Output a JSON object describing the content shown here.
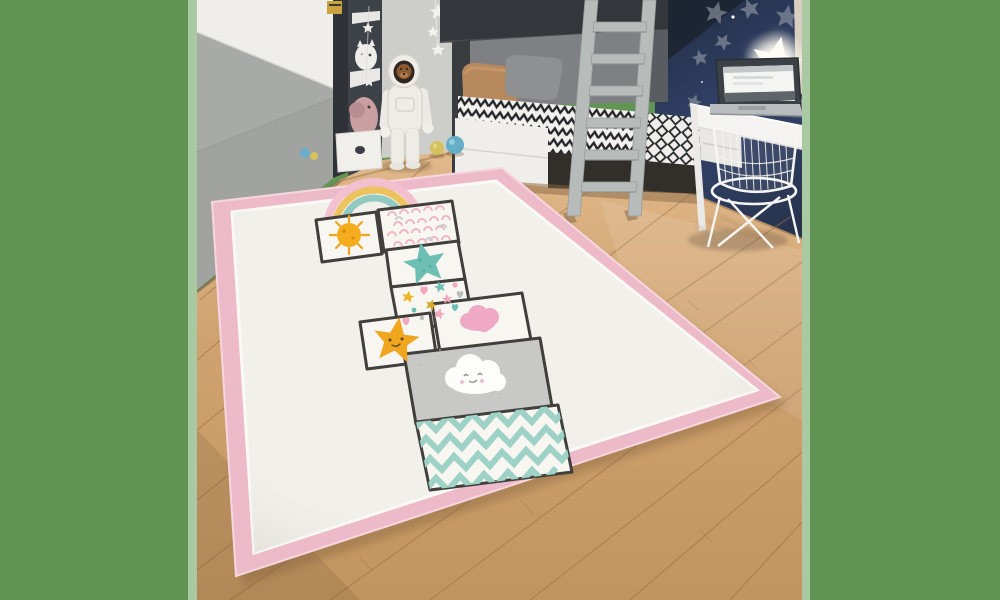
{
  "image_kind": "photograph",
  "description": "Children's bedroom with a large cream hopscotch play rug with pink border on a light oak floor; grey wardrobe and shelf unit on the left, astronaut figure, bunk bed with grey ladder, navy star wall with glowing star lamp, white desk with laptop and white wire chair on the right; solid green matte bands on both sides of the photo.",
  "matte": {
    "band_color": "#619353",
    "edge_strip_color": "#a9c9a3",
    "left_band_width_px": 197,
    "right_band_start_px": 802
  },
  "room": {
    "floor": "light oak laminate planks laid diagonally",
    "wardrobe": "grey sliding wardrobe with white angled wedge panel",
    "shelf_unit": "dark charcoal shelf column with white shelves, white cat ornament, pink elephant plush, white drawer box",
    "back_wall": "light grey wall with hanging white star garland",
    "astronaut_figure": "white astronaut suit figure with teddy-bear face in visor",
    "bunk_bed": "dark-frame bunk bed, black and white zigzag bedding, tan and grey pillows",
    "ladder": "light grey bunk ladder with six rungs",
    "navy_wall": "dark navy-blue wall scattered with soft grey stars",
    "star_lamp": "bright glowing white star night-light",
    "glow_text": "hel",
    "desk": "white desk with open laptop showing a white window",
    "chair": "white wire-frame chair",
    "balls": [
      "blue ball",
      "yellow-green ball",
      "small blue ball",
      "small yellow ball"
    ]
  },
  "rug": {
    "type": "hopscotch kids rug",
    "border_color": "#edbac9",
    "border_inner_line": "#fbf9f5",
    "field_color": "#f2f0ea",
    "outline_color": "#413f3c",
    "rainbow_colors": [
      "#f3c0d0",
      "#edc35e",
      "#92cac1"
    ],
    "tiles": [
      {
        "pos": 1,
        "motif": "scribbled sun",
        "color": "#f5ad1e"
      },
      {
        "pos": 2,
        "motif": "pink scallop pattern",
        "color": "#efb6c6"
      },
      {
        "pos": 3,
        "motif": "teal star",
        "color": "#6cbfb2"
      },
      {
        "pos": 4,
        "motif": "confetti stars, hearts and dots",
        "color": "#f2a9c0"
      },
      {
        "pos": 5,
        "motif": "smiling yellow star",
        "color": "#f0a61e"
      },
      {
        "pos": 6,
        "motif": "pink cloud",
        "color": "#efa9c4"
      },
      {
        "pos": 7,
        "motif": "white smiling cloud on grey",
        "color": "#c8c8c6"
      },
      {
        "pos": 8,
        "motif": "mint zigzag chevrons",
        "color": "#9ed2c6"
      }
    ]
  },
  "palette": {
    "wood_light": "#dfb687",
    "wood_dark": "#c0925e",
    "wardrobe_grey": "#a8aaa7",
    "charcoal": "#33363a",
    "navy_wall": "#2d3a55",
    "ladder_grey": "#b7bbba",
    "white_furniture": "#f2f1ee"
  }
}
